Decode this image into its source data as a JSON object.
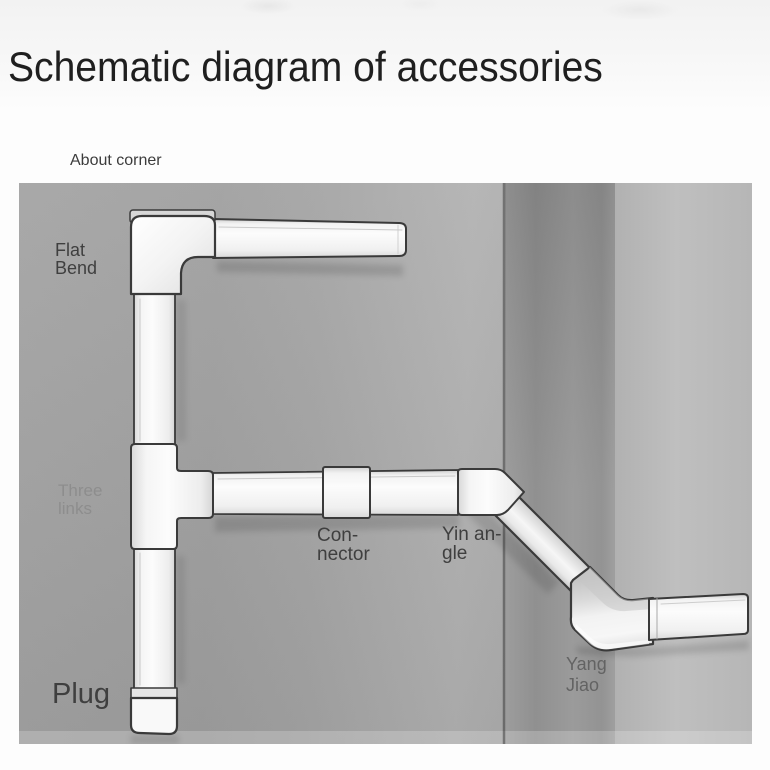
{
  "page": {
    "title": "Schematic diagram of accessories"
  },
  "diagram": {
    "caption": "About corner",
    "labels": {
      "flat_bend": {
        "line1": "Flat",
        "line2": "Bend"
      },
      "three_links": {
        "line1": "Three",
        "line2": "links"
      },
      "connector": {
        "line1": "Con-",
        "line2": "nector"
      },
      "yin_angle": {
        "line1": "Yin an-",
        "line2": "gle"
      },
      "yang_jiao": {
        "line1": "Yang",
        "line2": "Jiao"
      },
      "plug": {
        "label": "Plug"
      }
    },
    "colors": {
      "title": "#1f1f1f",
      "caption": "#3c3c3c",
      "label_dark": "#3f3f3f",
      "label_medium": "#636363",
      "label_faint": "#8d8d8d",
      "duct_outline": "#3a3a3a",
      "duct_fill": "#f4f4f4",
      "wall_left": "#a2a2a2",
      "wall_corner": "#8e8e8e",
      "wall_right": "#b9b9b9"
    }
  }
}
